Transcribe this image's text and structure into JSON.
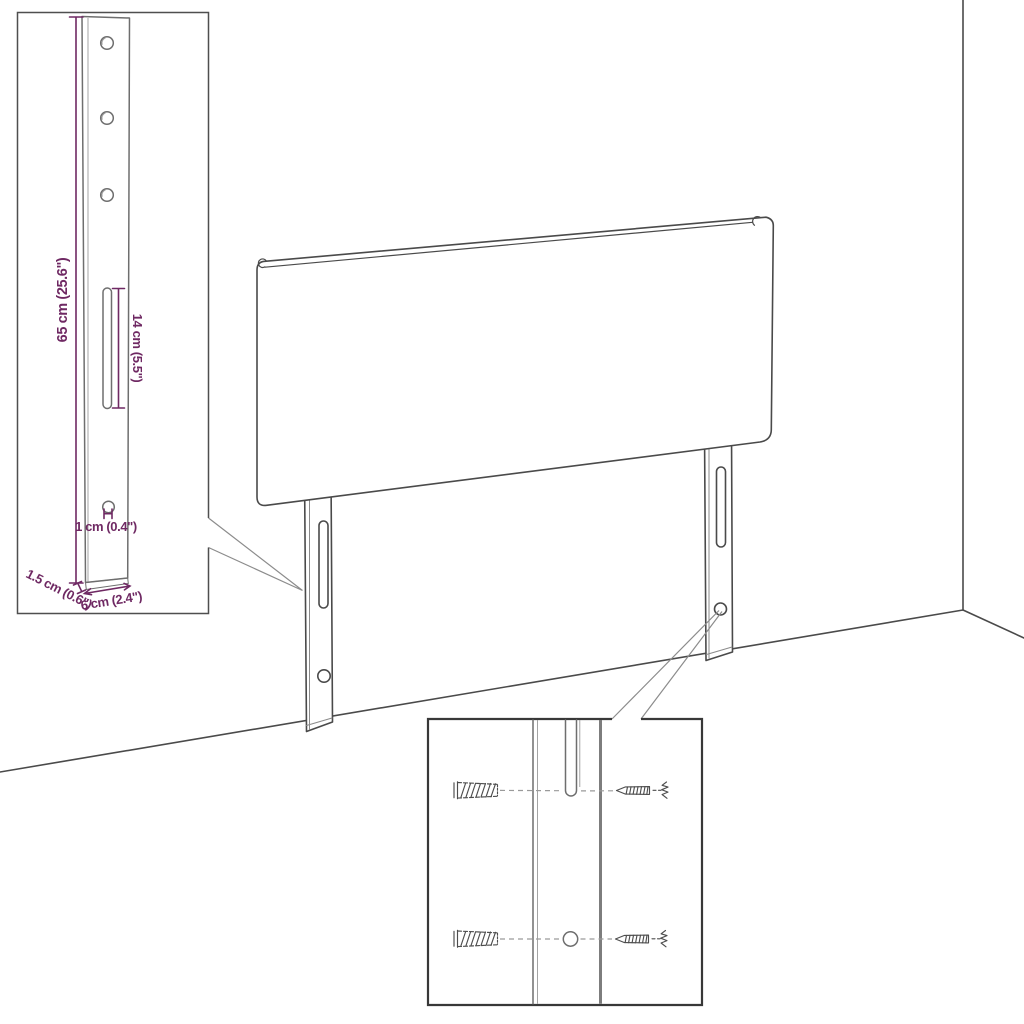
{
  "diagram": {
    "dimensions": {
      "bracket_height": "65 cm (25.6\")",
      "slot_length": "14 cm (5.5\")",
      "hole_diameter": "1 cm (0.4\")",
      "bracket_thickness": "1.5 cm (0.6\")",
      "bracket_width": "6 cm (2.4\")"
    },
    "colors": {
      "dimension_annotation": "#6f2963",
      "outline": "#4a4a4a",
      "inset_border": "#383838"
    }
  }
}
